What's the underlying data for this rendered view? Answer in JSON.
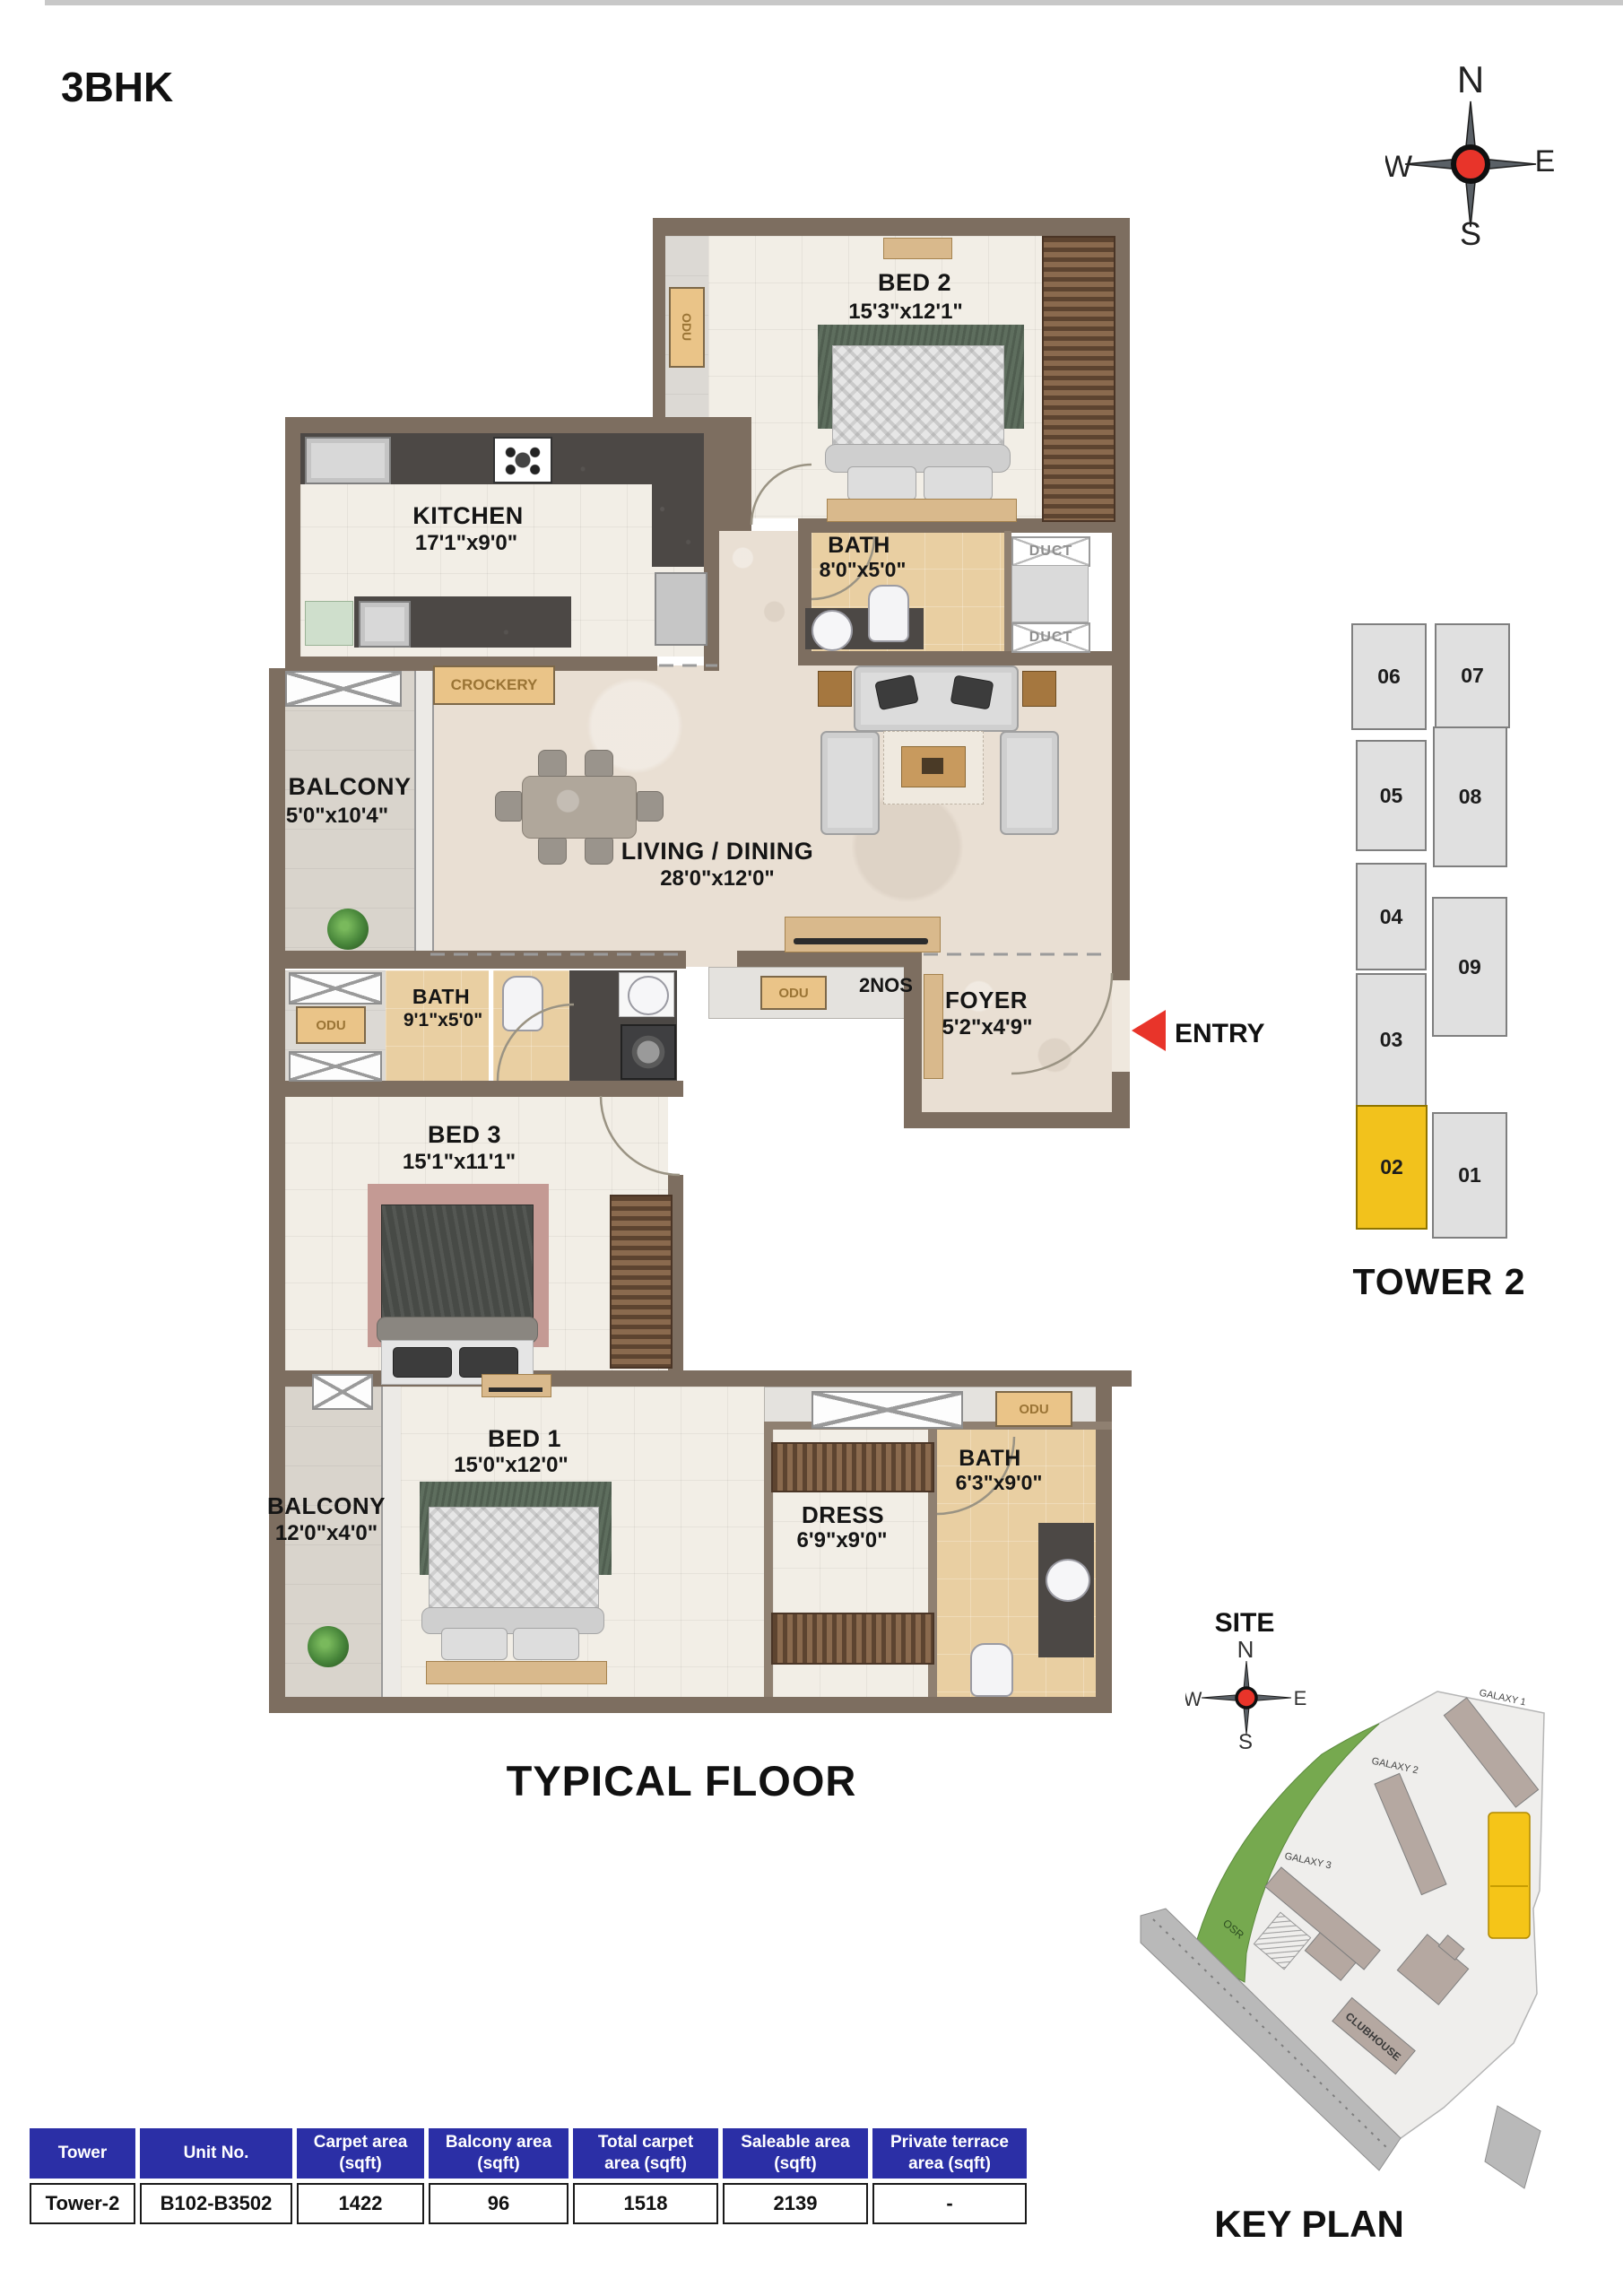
{
  "header": {
    "title": "3BHK"
  },
  "compass": {
    "n": "N",
    "e": "E",
    "s": "S",
    "w": "W"
  },
  "plan": {
    "caption": "TYPICAL FLOOR",
    "entry_label": "ENTRY",
    "rooms": [
      {
        "name": "BED 2",
        "dims": "15'3\"x12'1\""
      },
      {
        "name": "KITCHEN",
        "dims": "17'1\"x9'0\""
      },
      {
        "name": "BATH",
        "dims": "8'0\"x5'0\""
      },
      {
        "name": "BALCONY",
        "dims": "5'0\"x10'4\""
      },
      {
        "name": "LIVING / DINING",
        "dims": "28'0\"x12'0\""
      },
      {
        "name": "BATH",
        "dims": "9'1\"x5'0\""
      },
      {
        "name": "BED 3",
        "dims": "15'1\"x11'1\""
      },
      {
        "name": "FOYER",
        "dims": "5'2\"x4'9\""
      },
      {
        "name": "BED 1",
        "dims": "15'0\"x12'0\""
      },
      {
        "name": "BALCONY",
        "dims": "12'0\"x4'0\""
      },
      {
        "name": "DRESS",
        "dims": "6'9\"x9'0\""
      },
      {
        "name": "BATH",
        "dims": "6'3\"x9'0\""
      }
    ],
    "labels": {
      "crockery": "CROCKERY",
      "odu": "ODU",
      "odu_qty": "2NOS",
      "duct": "DUCT"
    }
  },
  "tower": {
    "title": "TOWER 2",
    "highlight_unit": "02",
    "units": [
      {
        "no": "06"
      },
      {
        "no": "07"
      },
      {
        "no": "05"
      },
      {
        "no": "08"
      },
      {
        "no": "04"
      },
      {
        "no": "09"
      },
      {
        "no": "03"
      },
      {
        "no": "02"
      },
      {
        "no": "01"
      }
    ]
  },
  "site": {
    "label": "SITE",
    "caption": "KEY PLAN",
    "buildings": {
      "g1": "GALAXY 1",
      "g2": "GALAXY 2",
      "g3": "GALAXY 3",
      "club": "CLUBHOUSE",
      "osr": "OSR"
    }
  },
  "table": {
    "headers": [
      {
        "l1": "Tower",
        "l2": ""
      },
      {
        "l1": "Unit No.",
        "l2": ""
      },
      {
        "l1": "Carpet area",
        "l2": "(sqft)"
      },
      {
        "l1": "Balcony area",
        "l2": "(sqft)"
      },
      {
        "l1": "Total carpet",
        "l2": "area (sqft)"
      },
      {
        "l1": "Saleable area",
        "l2": "(sqft)"
      },
      {
        "l1": "Private terrace",
        "l2": "area (sqft)"
      }
    ],
    "row": [
      "Tower-2",
      "B102-B3502",
      "1422",
      "96",
      "1518",
      "2139",
      "-"
    ]
  },
  "colors": {
    "accent_red": "#E8342A",
    "highlight_yellow": "#F2C21C",
    "table_header_blue": "#2B2FA6",
    "wall_brown": "#7D6E60"
  }
}
